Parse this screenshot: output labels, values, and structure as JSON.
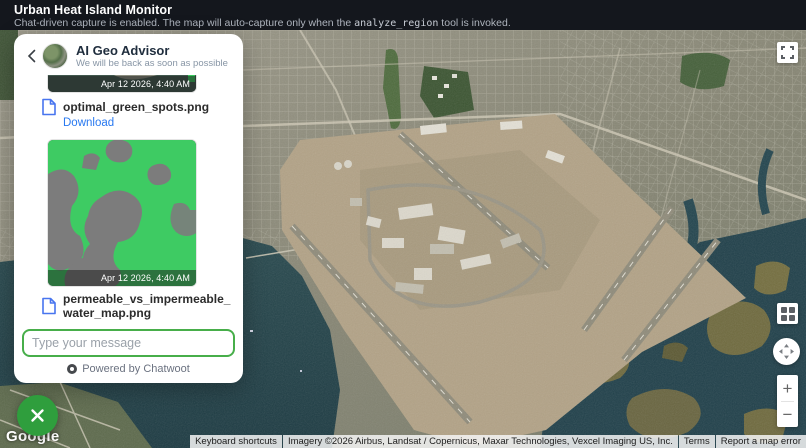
{
  "header": {
    "title": "Urban Heat Island Monitor",
    "subtitle_pre": "Chat-driven capture is enabled. The map will auto-capture only when the ",
    "subtitle_code": "analyze_region",
    "subtitle_post": " tool is invoked."
  },
  "chat": {
    "title": "AI Geo Advisor",
    "subtitle": "We will be back as soon as possible",
    "messages": [
      {
        "timestamp": "Apr 12 2026, 4:40 AM",
        "file_name": "optimal_green_spots.png",
        "download_label": "Download"
      },
      {
        "timestamp": "Apr 12 2026, 4:40 AM",
        "file_name": "permeable_vs_impermeable_water_map.png"
      }
    ],
    "input_placeholder": "Type your message",
    "footer": "Powered by Chatwoot"
  },
  "map": {
    "provider_logo": "Google",
    "attribution": {
      "keyboard": "Keyboard shortcuts",
      "imagery": "Imagery ©2026 Airbus, Landsat / Copernicus, Maxar Technologies, Vexcel Imaging US, Inc.",
      "terms": "Terms",
      "report": "Report a map error"
    },
    "controls": {
      "zoom_in": "+",
      "zoom_out": "−"
    }
  },
  "colors": {
    "header_bg": "#14171d",
    "accent_green": "#2f9e3d",
    "input_border_green": "#47ae4a",
    "link_blue": "#2979f0",
    "water": "#20404a",
    "marsh": "#6f6a3e",
    "airport_tan": "#b2a286"
  }
}
